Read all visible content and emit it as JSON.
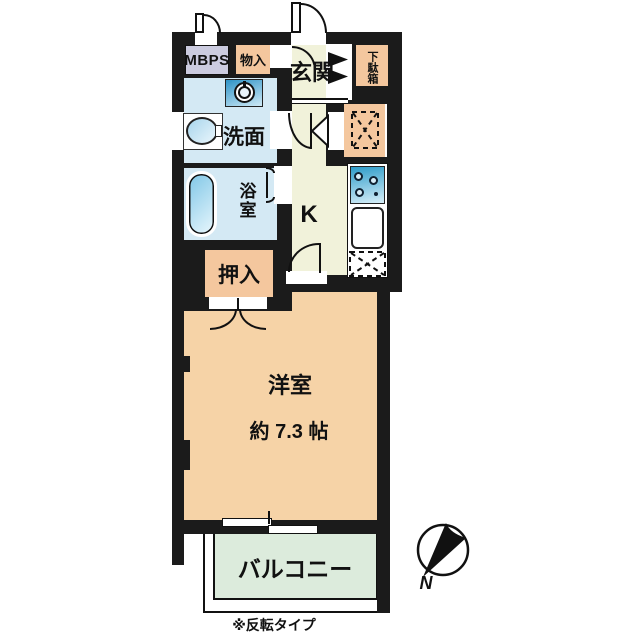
{
  "floorplan": {
    "note": "※反転タイプ",
    "compass": {
      "north_label": "N"
    },
    "colors": {
      "wall": "#1b1b1b",
      "meter_box": "#cbcbdf",
      "storage_orange": "#f4c79e",
      "entrance_cream": "#f1f2da",
      "water_blue": "#d4e9f4",
      "room_peach": "#f6d3a7",
      "balcony_green": "#dcebdc",
      "appliance_blue": "#3f9fd0"
    },
    "rooms": {
      "meter_box": {
        "label": "MBPS"
      },
      "storage": {
        "label": "物入"
      },
      "entrance": {
        "label": "玄関"
      },
      "shoe_cabinet": {
        "label": "下駄箱"
      },
      "washroom": {
        "label": "洗面"
      },
      "bathroom": {
        "label": "浴室"
      },
      "kitchen": {
        "label": "K"
      },
      "closet": {
        "label": "押入"
      },
      "western_room": {
        "label": "洋室",
        "size_label": "約 7.3 帖"
      },
      "balcony": {
        "label": "バルコニー"
      }
    }
  }
}
